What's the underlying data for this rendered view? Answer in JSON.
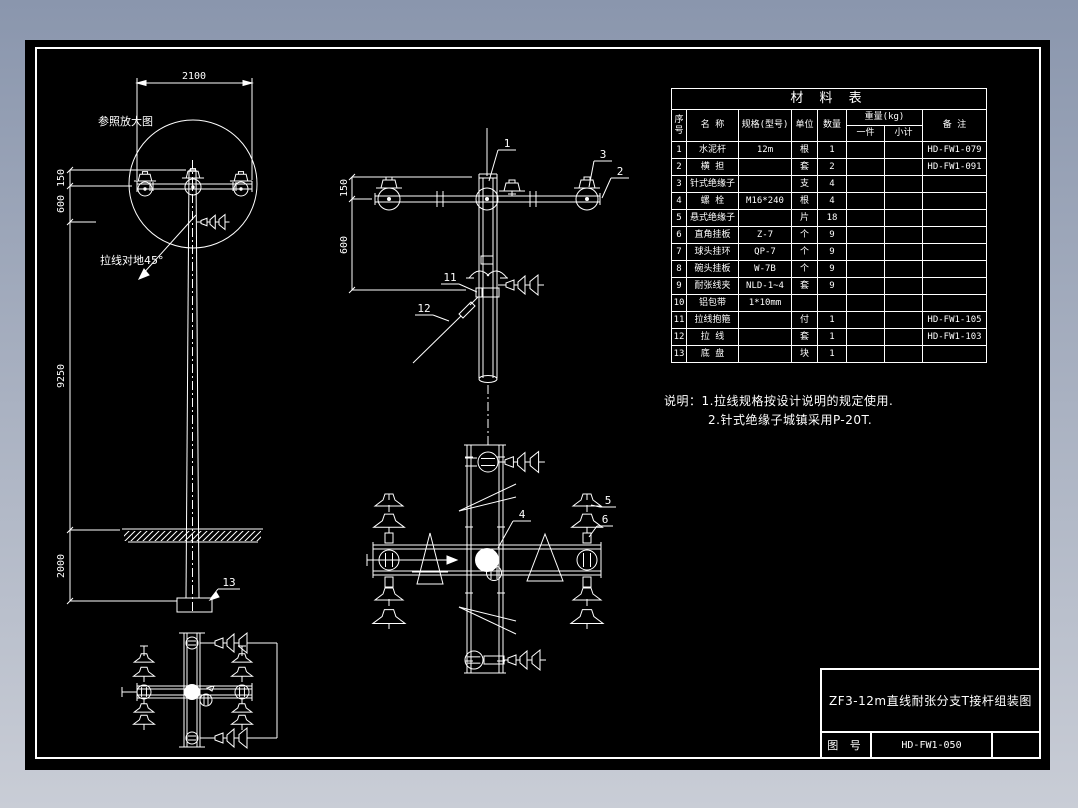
{
  "page": {
    "bg_top": "#8a96ad",
    "bg_bottom": "#c9cdd6",
    "paper": "#000000",
    "ink": "#ffffff"
  },
  "materials_table": {
    "title": "材  料  表",
    "headers": {
      "no": "序号",
      "name": "名  称",
      "spec": "规格(型号)",
      "unit": "单位",
      "qty": "数量",
      "weight": "重量(kg)",
      "w_each": "一件",
      "w_sub": "小计",
      "note": "备  注"
    },
    "rows": [
      {
        "no": "1",
        "name": "水泥杆",
        "spec": "12m",
        "unit": "根",
        "qty": "1",
        "w_each": "",
        "w_sub": "",
        "note": "HD-FW1-079"
      },
      {
        "no": "2",
        "name": "横 担",
        "spec": "",
        "unit": "套",
        "qty": "2",
        "w_each": "",
        "w_sub": "",
        "note": "HD-FW1-091"
      },
      {
        "no": "3",
        "name": "针式绝缘子",
        "spec": "",
        "unit": "支",
        "qty": "4",
        "w_each": "",
        "w_sub": "",
        "note": ""
      },
      {
        "no": "4",
        "name": "螺 栓",
        "spec": "M16*240",
        "unit": "根",
        "qty": "4",
        "w_each": "",
        "w_sub": "",
        "note": ""
      },
      {
        "no": "5",
        "name": "悬式绝缘子",
        "spec": "",
        "unit": "片",
        "qty": "18",
        "w_each": "",
        "w_sub": "",
        "note": ""
      },
      {
        "no": "6",
        "name": "直角挂板",
        "spec": "Z-7",
        "unit": "个",
        "qty": "9",
        "w_each": "",
        "w_sub": "",
        "note": ""
      },
      {
        "no": "7",
        "name": "球头挂环",
        "spec": "QP-7",
        "unit": "个",
        "qty": "9",
        "w_each": "",
        "w_sub": "",
        "note": ""
      },
      {
        "no": "8",
        "name": "碗头挂板",
        "spec": "W-7B",
        "unit": "个",
        "qty": "9",
        "w_each": "",
        "w_sub": "",
        "note": ""
      },
      {
        "no": "9",
        "name": "耐张线夹",
        "spec": "NLD-1~4",
        "unit": "套",
        "qty": "9",
        "w_each": "",
        "w_sub": "",
        "note": ""
      },
      {
        "no": "10",
        "name": "铝包带",
        "spec": "1*10mm",
        "unit": "",
        "qty": "",
        "w_each": "",
        "w_sub": "",
        "note": ""
      },
      {
        "no": "11",
        "name": "拉线抱箍",
        "spec": "",
        "unit": "付",
        "qty": "1",
        "w_each": "",
        "w_sub": "",
        "note": "HD-FW1-105"
      },
      {
        "no": "12",
        "name": "拉 线",
        "spec": "",
        "unit": "套",
        "qty": "1",
        "w_each": "",
        "w_sub": "",
        "note": "HD-FW1-103"
      },
      {
        "no": "13",
        "name": "底 盘",
        "spec": "",
        "unit": "块",
        "qty": "1",
        "w_each": "",
        "w_sub": "",
        "note": ""
      }
    ]
  },
  "notes": {
    "line1": "说明：1.拉线规格按设计说明的规定使用.",
    "line2": "2.针式绝缘子城镇采用P-20T."
  },
  "title_block": {
    "title": "ZF3-12m直线耐张分支T接杆组装图",
    "label": "图 号",
    "number": "HD-FW1-050"
  },
  "dimensions": {
    "span_2100": "2100",
    "left_150": "150",
    "left_600": "600",
    "left_9250": "9250",
    "left_2000": "2000",
    "mid_150": "150",
    "mid_600": "600"
  },
  "callouts": {
    "c1": "1",
    "c2": "2",
    "c3": "3",
    "c4": "4",
    "c5": "5",
    "c6": "6",
    "c11": "11",
    "c12": "12",
    "c13": "13"
  },
  "annotations": {
    "enlarged_ref": "参照放大图",
    "stay_angle": "拉线对地45°"
  }
}
